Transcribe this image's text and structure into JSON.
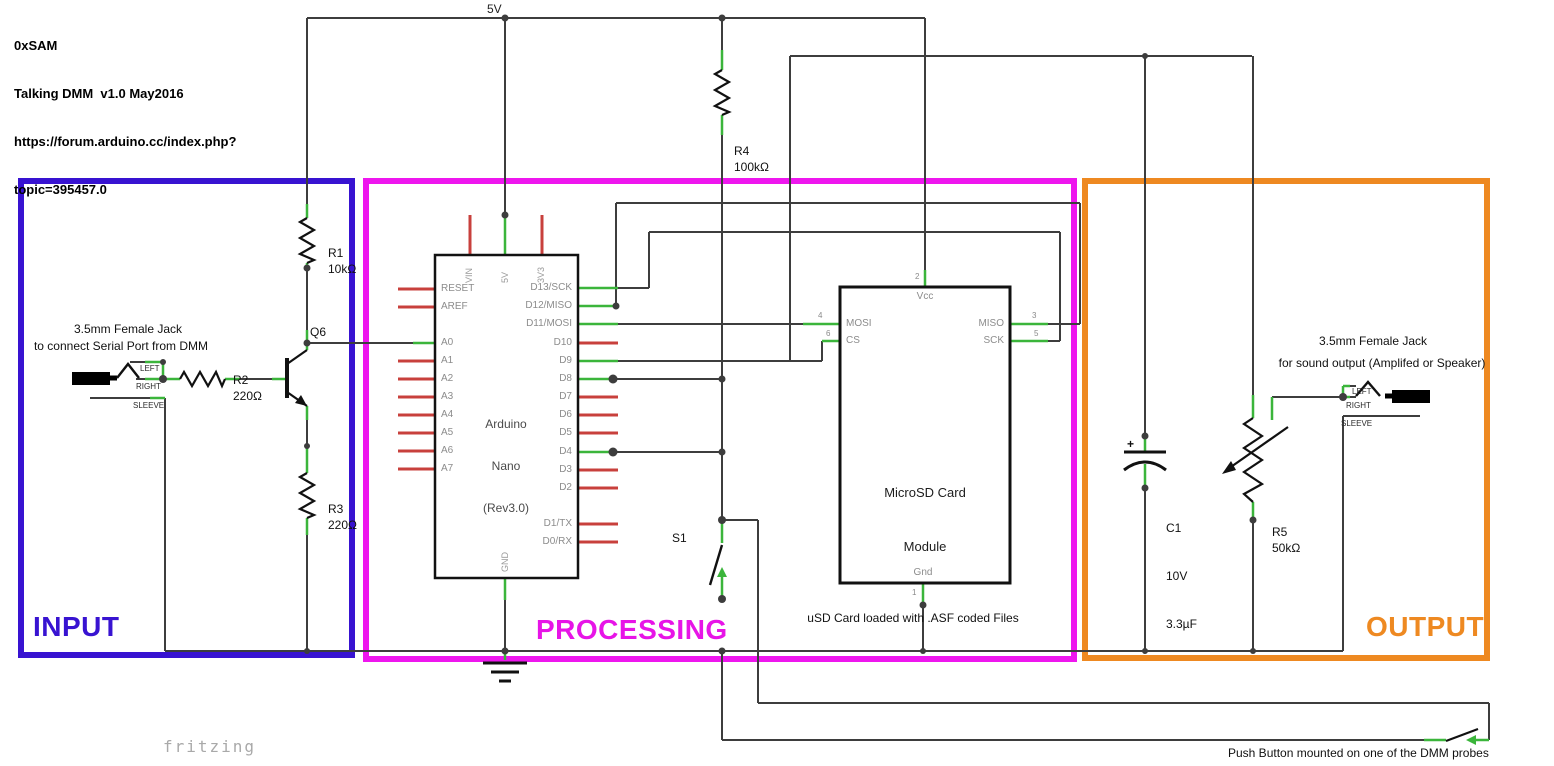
{
  "header": {
    "lines": [
      "0xSAM",
      "Talking DMM  v1.0 May2016",
      "https://forum.arduino.cc/index.php?",
      "topic=395457.0"
    ]
  },
  "power": {
    "rail_label": "5V"
  },
  "watermark": "fritzing",
  "push_button_note": "Push Button mounted on one of the DMM probes",
  "sections": {
    "input": {
      "label": "INPUT",
      "color": "#3813d1"
    },
    "processing": {
      "label": "PROCESSING",
      "color": "#ee16ee"
    },
    "output": {
      "label": "OUTPUT",
      "color": "#ee8921"
    }
  },
  "input": {
    "jack": {
      "title": "3.5mm Female Jack",
      "subtitle": "to connect Serial Port from DMM",
      "pins": [
        "LEFT",
        "RIGHT",
        "SLEEVE"
      ]
    },
    "r1": {
      "name": "R1",
      "value": "10kΩ"
    },
    "r2": {
      "name": "R2",
      "value": "220Ω"
    },
    "r3": {
      "name": "R3",
      "value": "220Ω"
    },
    "q6": {
      "name": "Q6"
    }
  },
  "processing": {
    "r4": {
      "name": "R4",
      "value": "100kΩ"
    },
    "s1": {
      "name": "S1"
    },
    "arduino": {
      "title_lines": [
        "Arduino",
        "Nano",
        "(Rev3.0)"
      ],
      "top_pins": [
        "VIN",
        "5V",
        "3V3"
      ],
      "bottom_pin": "GND",
      "left_pins": [
        "RESET",
        "AREF",
        "A0",
        "A1",
        "A2",
        "A3",
        "A4",
        "A5",
        "A6",
        "A7"
      ],
      "right_pins": [
        "D13/SCK",
        "D12/MISO",
        "D11/MOSI",
        "D10",
        "D9",
        "D8",
        "D7",
        "D6",
        "D5",
        "D4",
        "D3",
        "D2",
        "D1/TX",
        "D0/RX"
      ]
    },
    "sd": {
      "title_lines": [
        "MicroSD Card",
        "Module"
      ],
      "pins": {
        "vcc": {
          "label": "Vcc",
          "number": "2"
        },
        "mosi": {
          "label": "MOSI",
          "number": "4"
        },
        "cs": {
          "label": "CS",
          "number": "6"
        },
        "miso": {
          "label": "MISO",
          "number": "3"
        },
        "sck": {
          "label": "SCK",
          "number": "5"
        },
        "gnd": {
          "label": "Gnd",
          "number": "1"
        }
      }
    },
    "sd_note": "uSD Card loaded with .ASF coded Files"
  },
  "output": {
    "jack": {
      "title": "3.5mm Female Jack",
      "subtitle": "for sound output (Amplifed or Speaker)",
      "pins": [
        "LEFT",
        "RIGHT",
        "SLEEVE"
      ]
    },
    "c1": {
      "lines": [
        "C1",
        "10V",
        "3.3µF"
      ]
    },
    "r5": {
      "name": "R5",
      "value": "50kΩ"
    }
  },
  "colors": {
    "wire": "#3d3d3d",
    "connected_pin": "#3bb53b",
    "unconnected_pin": "#c8403c",
    "component_outline": "#111111"
  }
}
